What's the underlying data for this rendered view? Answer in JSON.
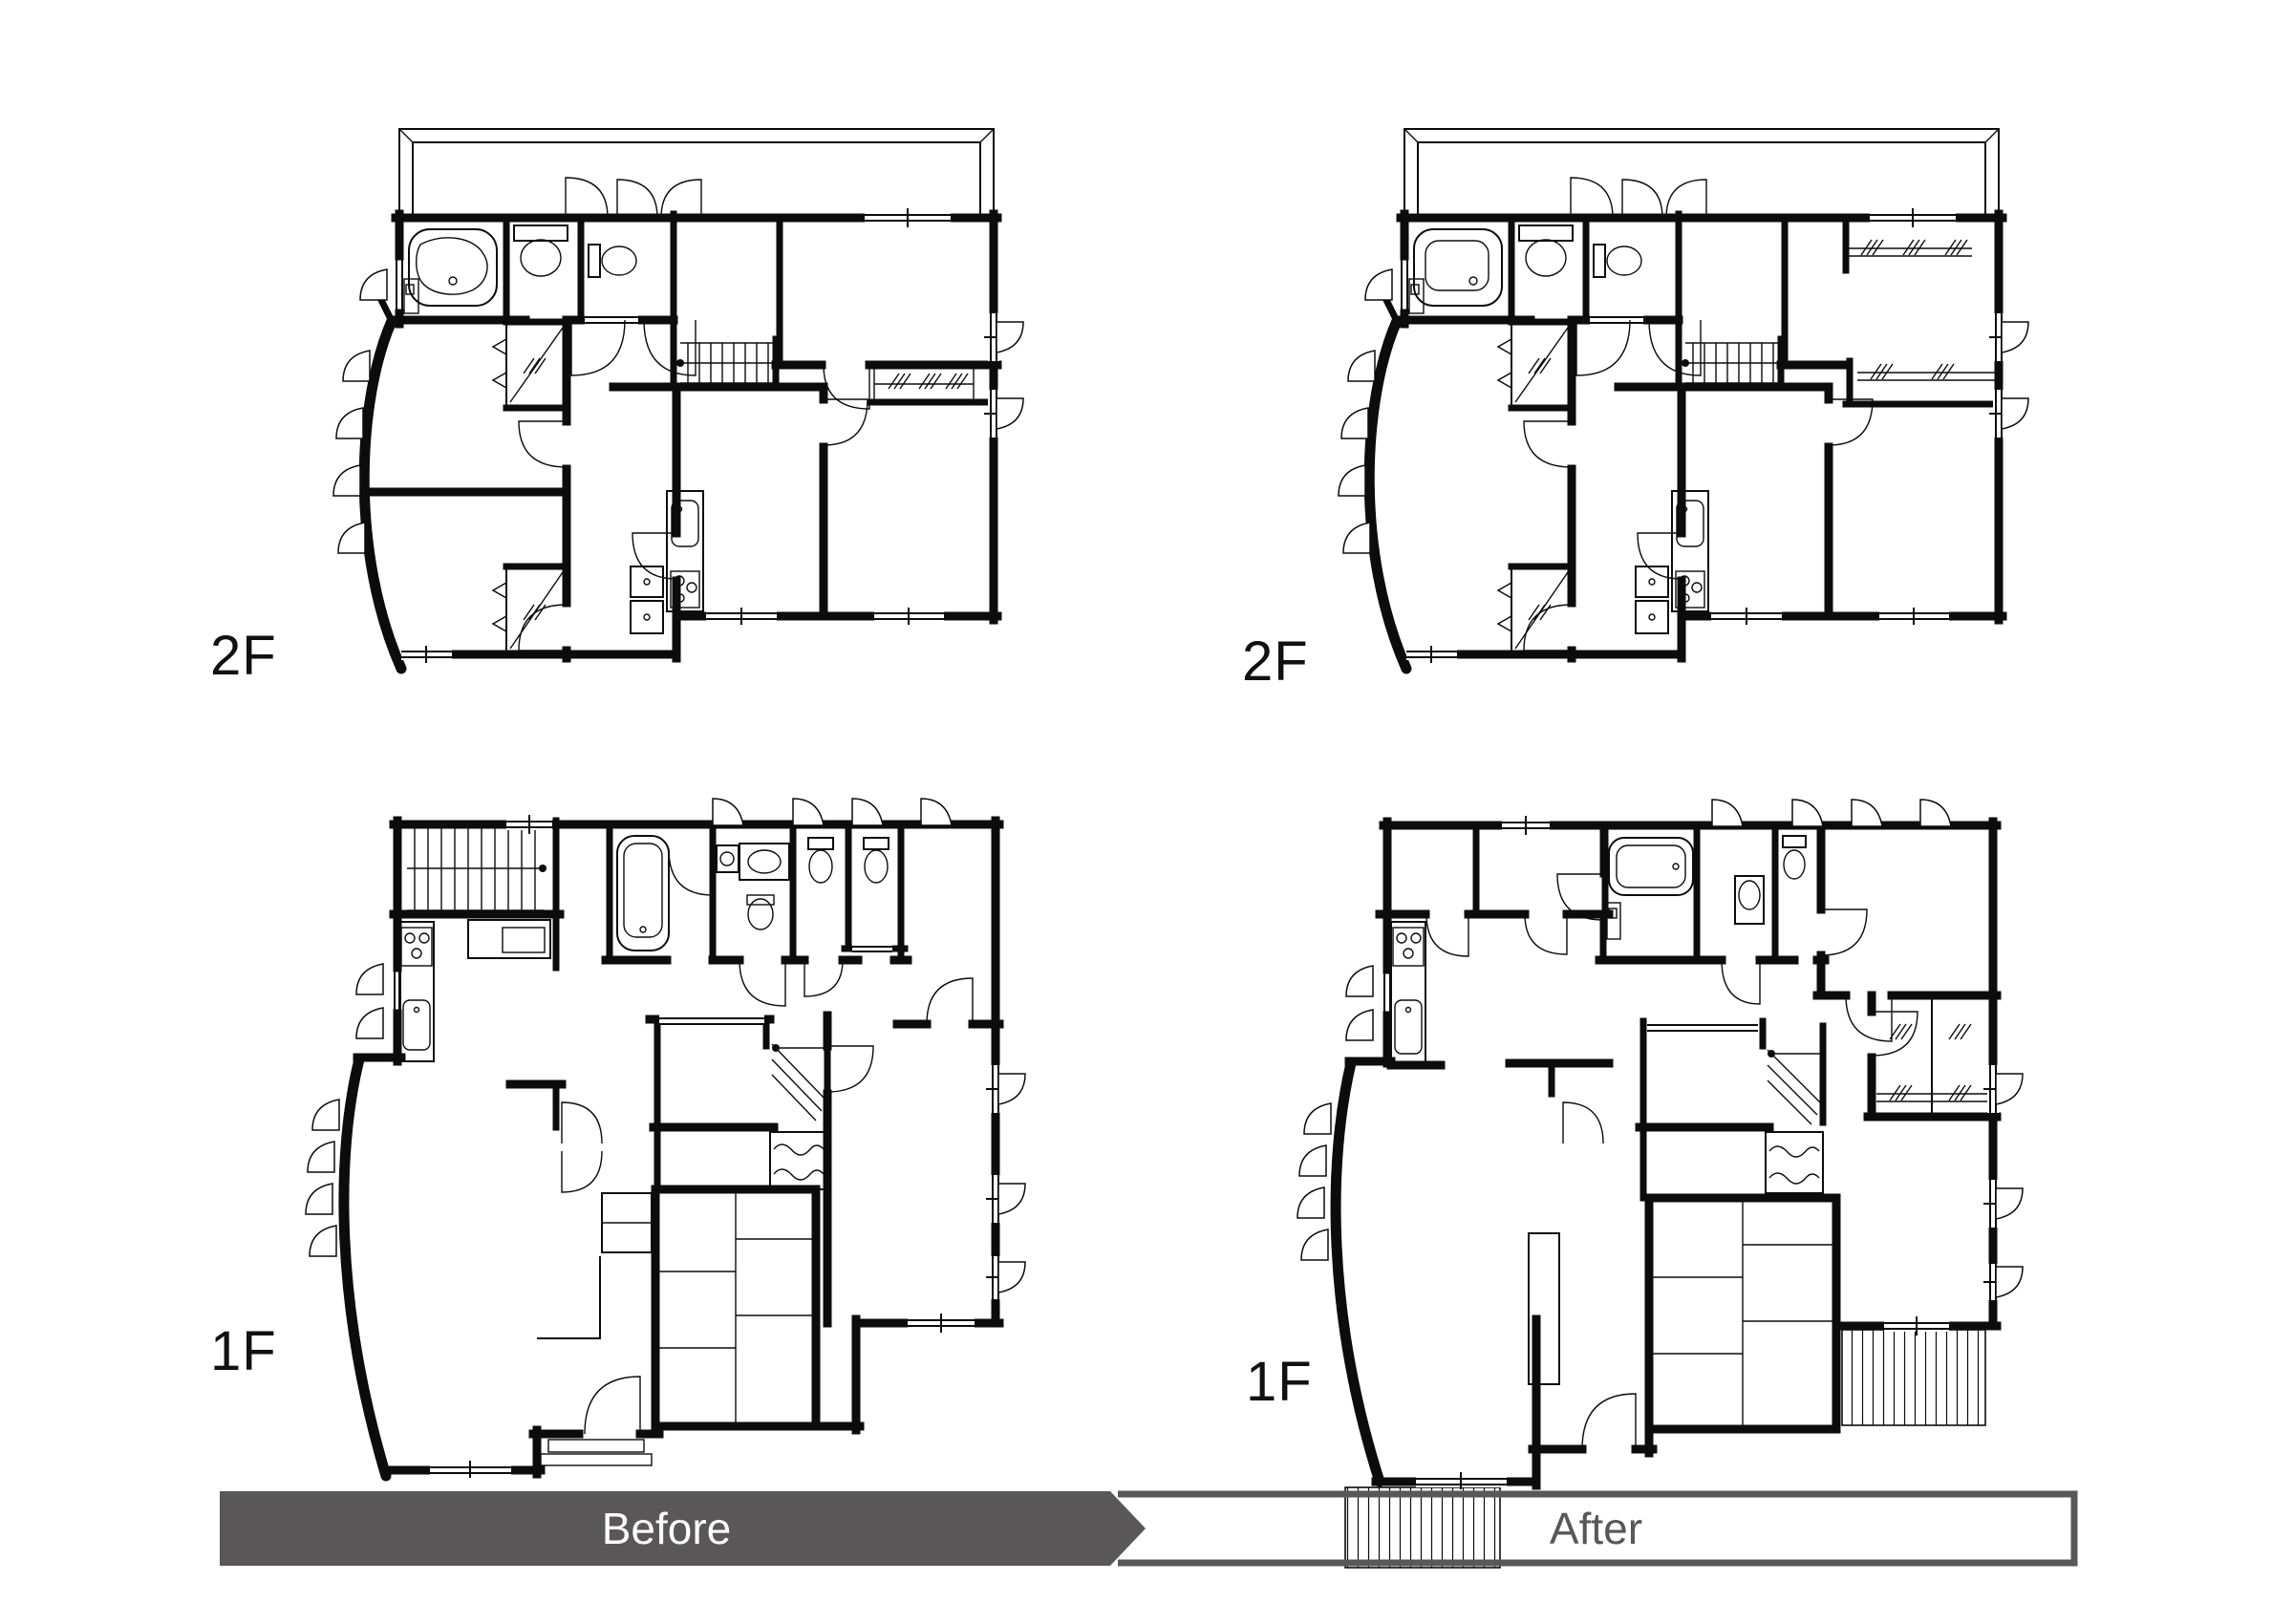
{
  "document": {
    "kind": "renovation-floorplan-comparison",
    "background": "#ffffff"
  },
  "plans": [
    {
      "id": "2f-before",
      "floor_label": "2F",
      "phase": "before",
      "position": "top-left"
    },
    {
      "id": "2f-after",
      "floor_label": "2F",
      "phase": "after",
      "position": "top-right"
    },
    {
      "id": "1f-before",
      "floor_label": "1F",
      "phase": "before",
      "position": "bottom-left"
    },
    {
      "id": "1f-after",
      "floor_label": "1F",
      "phase": "after",
      "position": "bottom-right"
    }
  ],
  "banner": {
    "before_label": "Before",
    "after_label": "After",
    "before_bg": "#595757",
    "before_text_color": "#ffffff",
    "after_bg": "#ffffff",
    "after_border": "#595757",
    "after_text_color": "#595757"
  },
  "colors": {
    "line": "#0c0c0c",
    "accent_gray": "#595757",
    "paper": "#ffffff"
  },
  "icons": {
    "bathtub-icon": "rounded-rect tub with inner basin and drain dot",
    "toilet-icon": "tank rectangle with oval bowl",
    "vanity-sink-icon": "rectangle with oval basin",
    "kitchen-sink-icon": "rounded rectangle with faucet dot",
    "stove-icon": "rectangle with three burner circles",
    "stairs-icon": "parallel tread lines with start dot",
    "door-arc-icon": "quarter-circle swing arc",
    "sliding-door-icon": "double parallel lines in wall gap",
    "window-icon": "double parallel lines with center tick",
    "casement-window-icon": "quarter fan outside wall",
    "closet-hanger-icon": "diagonal pipe with /// marks",
    "folding-door-icon": "chevron marks",
    "tatami-grid-icon": "mat seam grid",
    "wood-floor-icon": "wavy grain strokes",
    "deck-icon": "vertical plank stripes",
    "balcony-icon": "thin double outline",
    "curved-wall-icon": "thick bowed wall with fans"
  }
}
